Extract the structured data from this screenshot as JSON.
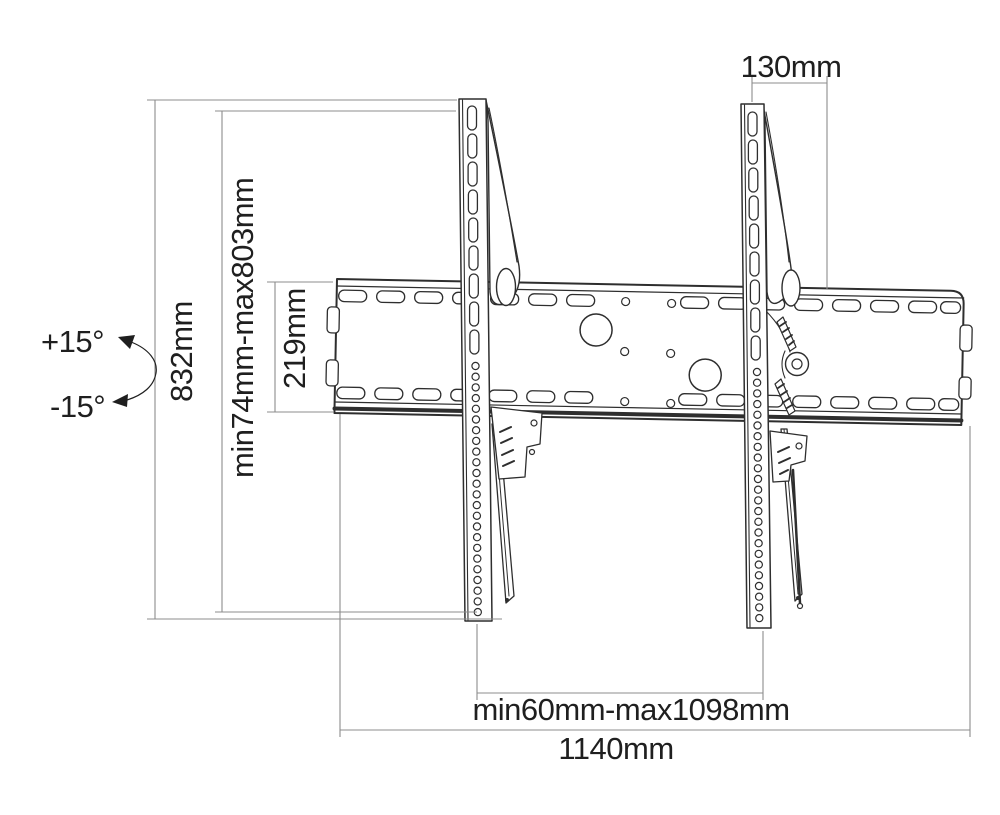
{
  "page": {
    "background": "#ffffff"
  },
  "diagram": {
    "title": "Tilting TV wall mount dimensional drawing",
    "colors": {
      "drawing": "#2e2e2e",
      "dimension": "#8c8c8c",
      "text": "#1f1f1f",
      "background": "#ffffff"
    },
    "labels": {
      "bracket_depth_top": "130mm",
      "total_height": "832mm",
      "mount_height_range": "min74mm-max803mm",
      "wall_plate_height": "219mm",
      "bracket_span_range": "min60mm-max1098mm",
      "total_width": "1140mm",
      "tilt_up": "+15°",
      "tilt_down": "-15°"
    }
  }
}
